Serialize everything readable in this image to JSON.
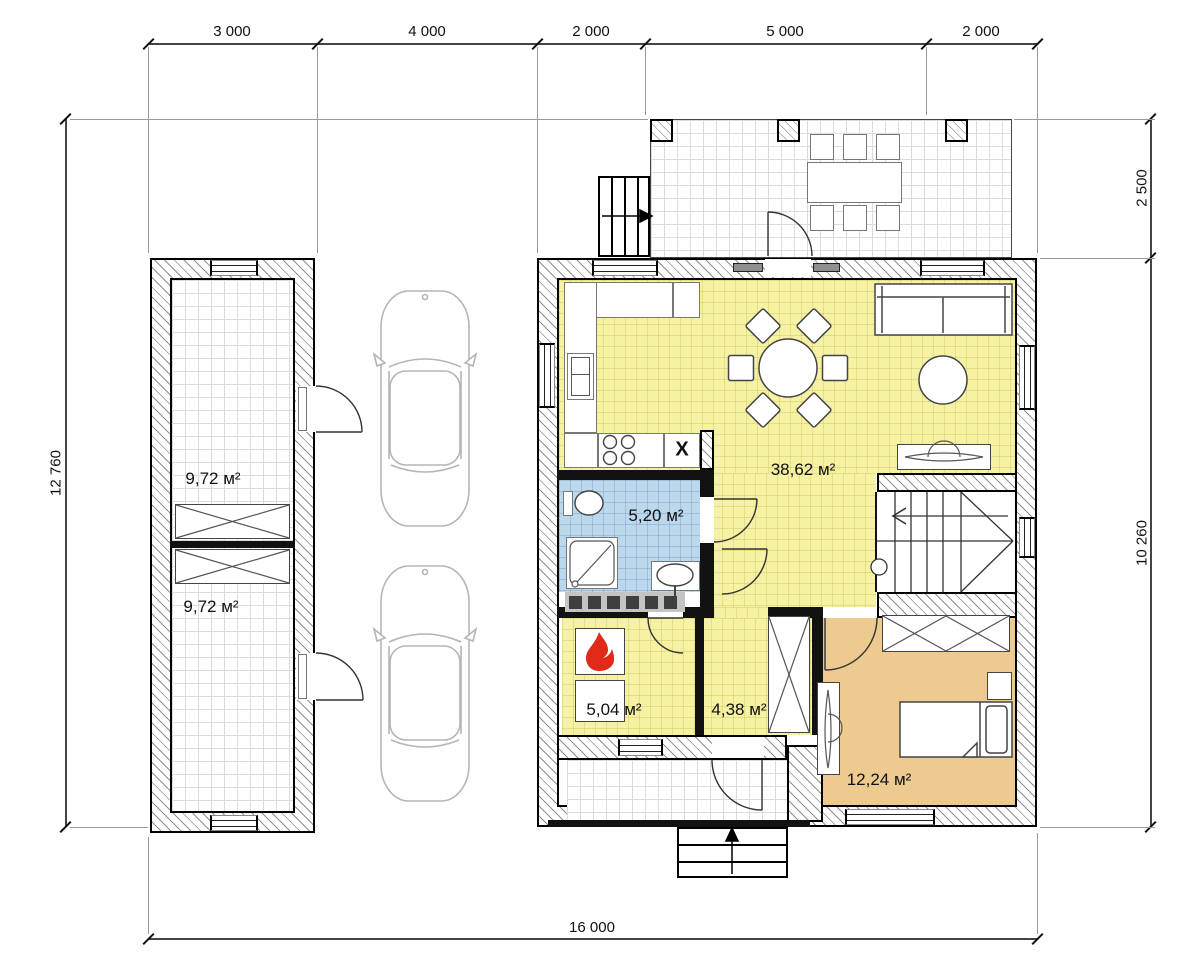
{
  "dimensions": {
    "top_segments": [
      "3 000",
      "4 000",
      "2 000",
      "5 000",
      "2 000"
    ],
    "left_total": "12 760",
    "right_upper": "2 500",
    "right_lower": "10 260",
    "bottom_total": "16 000"
  },
  "rooms": {
    "garage_room_1": "9,72 м²",
    "garage_room_2": "9,72 м²",
    "living_kitchen": "38,62 м²",
    "bathroom": "5,20 м²",
    "boiler_room": "5,04 м²",
    "hallway": "4,38 м²",
    "bedroom": "12,24 м²"
  },
  "kitchen": {
    "sink_mark": "X"
  },
  "colors": {
    "room_yellow": "#f6f2a4",
    "bathroom_blue": "#bcd8ec",
    "bedroom_tan": "#ecca90",
    "flame_red": "#e02a1a",
    "grid_line": "#dcdcdc"
  }
}
